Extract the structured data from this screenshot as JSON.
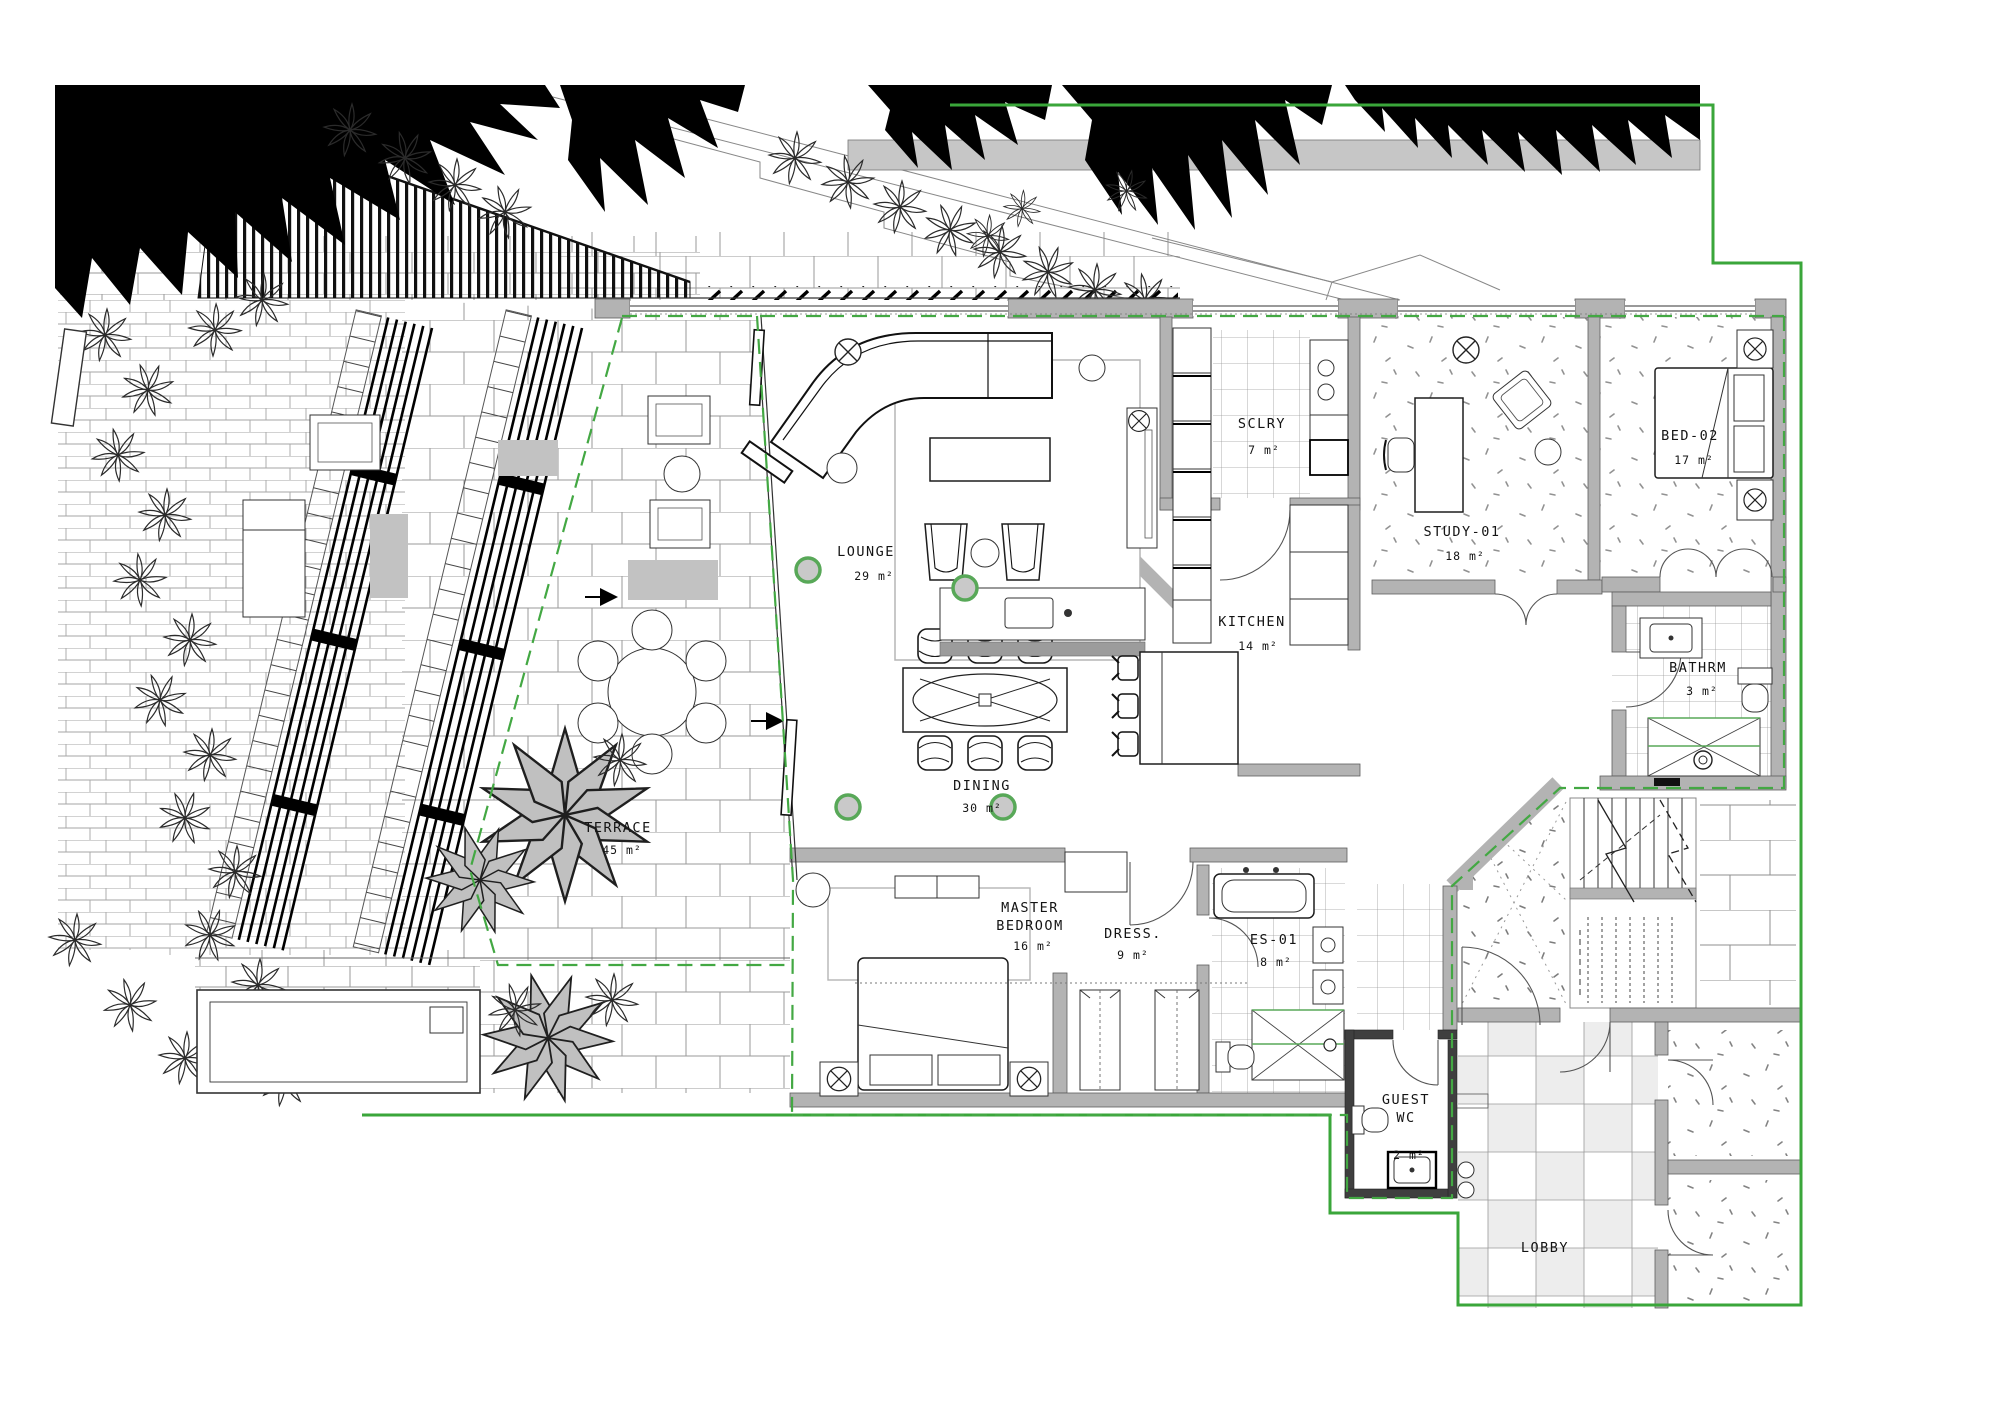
{
  "drawing": {
    "type": "architectural-floor-plan",
    "colors": {
      "boundary_green": "#3aa63a",
      "demise_dashed_green": "#43a843",
      "wall_gray": "#b3b3b3",
      "linework_black": "#1d1d1d",
      "tree_canopy_black": "#000000"
    }
  },
  "rooms": {
    "lounge": {
      "label": "LOUNGE",
      "area": "29 m²"
    },
    "dining": {
      "label": "DINING",
      "area": "30 m²"
    },
    "kitchen": {
      "label": "KITCHEN",
      "area": "14 m²"
    },
    "scullery": {
      "label": "SCLRY",
      "area": "7 m²"
    },
    "study": {
      "label": "STUDY-01",
      "area": "18 m²"
    },
    "bed02": {
      "label": "BED-02",
      "area": "17 m²"
    },
    "bathroom": {
      "label": "BATHRM",
      "area": "3 m²"
    },
    "master": {
      "label1": "MASTER",
      "label2": "BEDROOM",
      "area": "16 m²"
    },
    "dress": {
      "label": "DRESS.",
      "area": "9 m²"
    },
    "ensuite": {
      "label": "ES-01",
      "area": "8 m²"
    },
    "guestwc": {
      "label1": "GUEST",
      "label2": "WC",
      "area": "2 m²"
    },
    "lobby": {
      "label": "LOBBY"
    },
    "terrace": {
      "label": "TERRACE",
      "area": "45 m²"
    }
  }
}
